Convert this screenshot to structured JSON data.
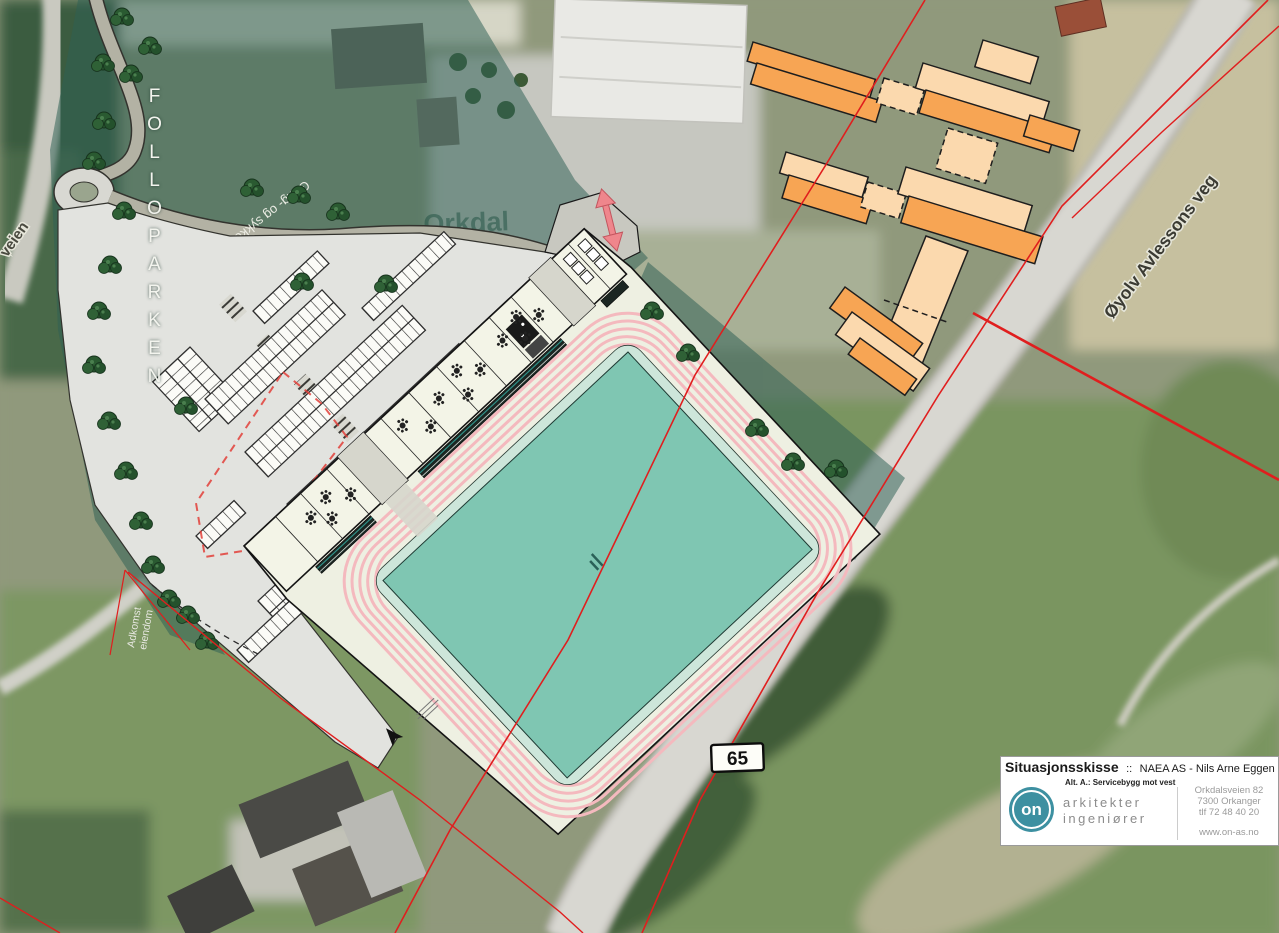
{
  "labels": {
    "folloparken": "FOLLOPARKEN",
    "gang_sykkelvei": "Gang- og sykkelvei",
    "orkdal_line1": "Orkdal",
    "orkdal_line2": "vidaregåande",
    "oyolv_veg": "Øyolv Avlessons veg",
    "veien_partial": "veien",
    "adkomst_line1": "Adkomst",
    "adkomst_line2": "eiendom",
    "route_number": "65"
  },
  "title_block": {
    "title": "Situasjonsskisse",
    "separator": "::",
    "project": "NAEA AS - Nils Arne Eggen arena",
    "date": "27.9.",
    "alt_note": "Alt. A.: Servicebygg mot vest",
    "logo_text": "on",
    "firm_line1": "arkitekter",
    "firm_line2": "ingeniører",
    "address_line1": "Orkdalsveien 82",
    "address_line2": "7300 Orkanger",
    "address_line3": "tlf 72 48 40 20",
    "website": "www.on-as.no"
  },
  "colors": {
    "field_teal": "#7fc6b2",
    "track_pink": "#f4b9be",
    "new_building_orange": "#f7a554",
    "new_building_orange_light": "#fbd9ae",
    "boundary_red": "#e01e1e",
    "park_overlay_teal": "#2e5f55",
    "logo_teal": "#3d90a1"
  }
}
